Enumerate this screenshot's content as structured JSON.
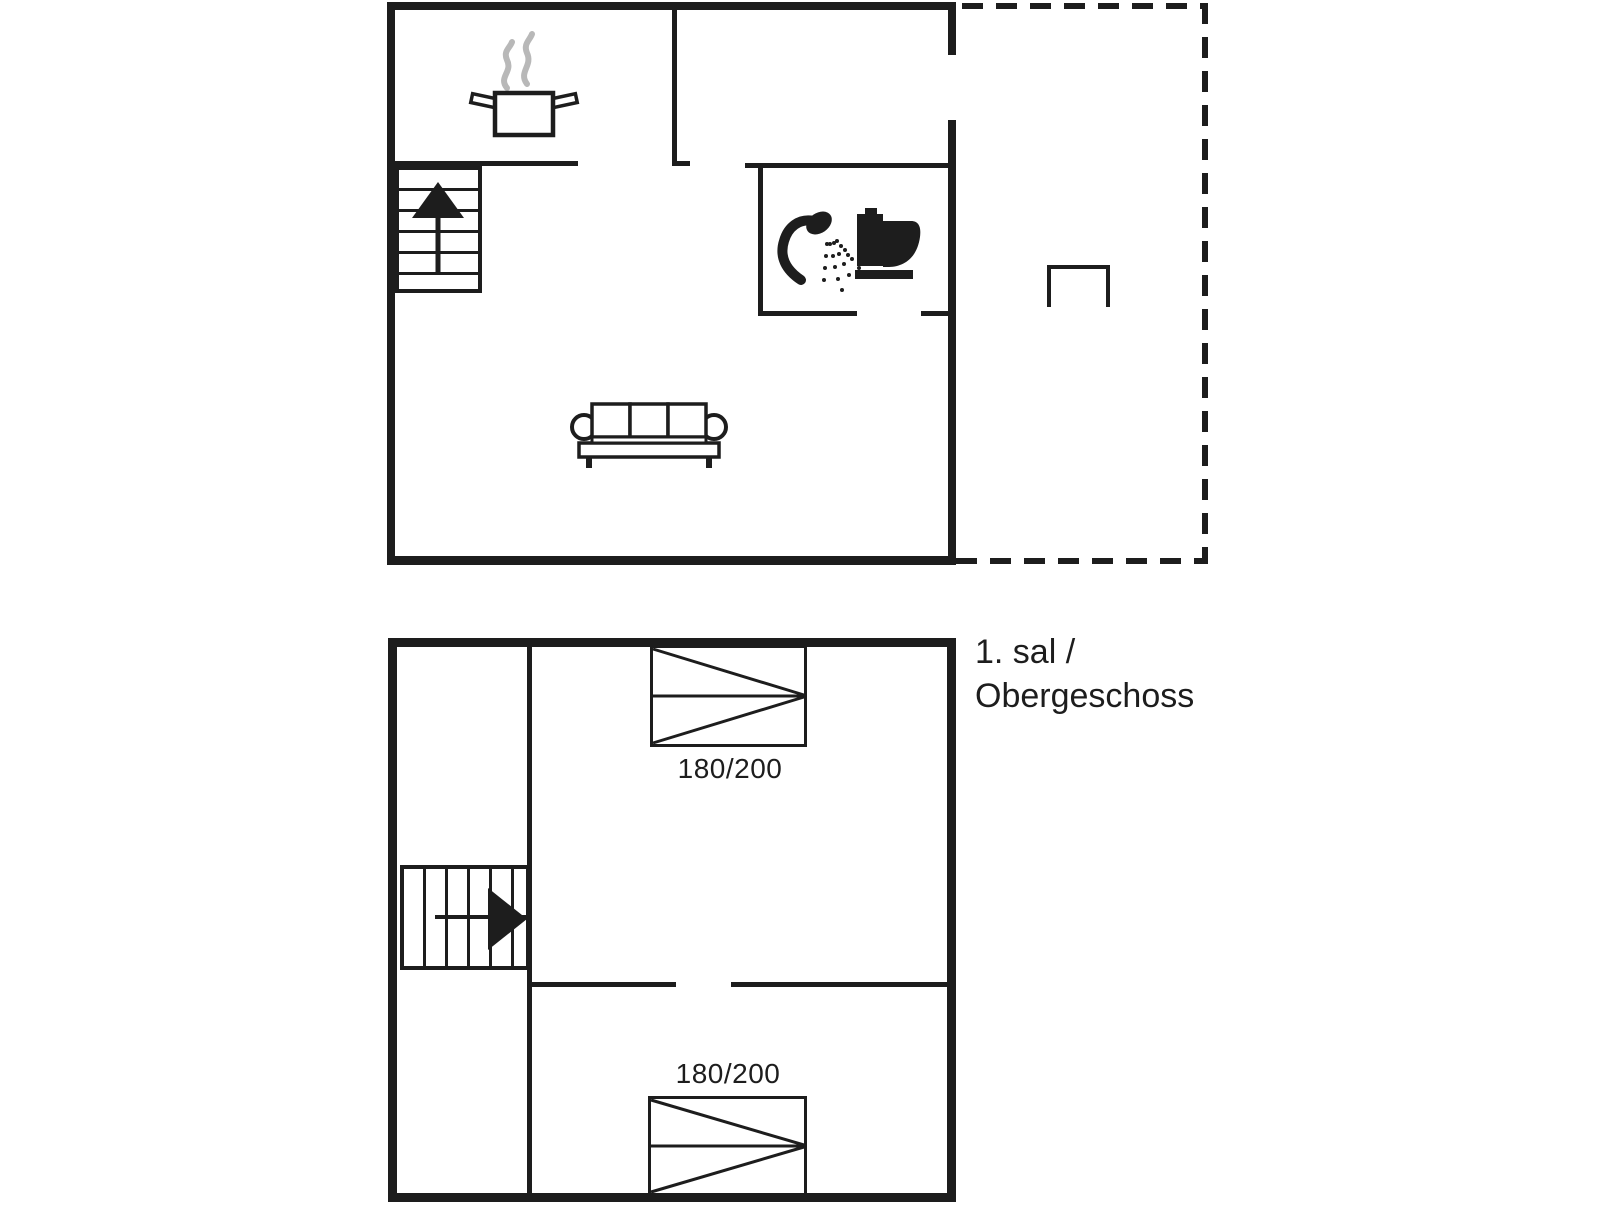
{
  "colors": {
    "wall": "#1d1d1d",
    "steam": "#b8b8b8",
    "background": "#ffffff"
  },
  "ground_floor": {
    "icons": {
      "kitchen": "pot-with-steam",
      "stairs": "stairs-up-arrow",
      "bathroom": [
        "shower",
        "toilet"
      ],
      "living_room": "sofa",
      "terrace": "bench-outline"
    }
  },
  "upper_floor": {
    "title_line1": "1. sal /",
    "title_line2": "Obergeschoss",
    "icons": {
      "stairs": "stairs-right-arrow"
    },
    "beds": [
      {
        "size": "180/200"
      },
      {
        "size": "180/200"
      }
    ]
  }
}
